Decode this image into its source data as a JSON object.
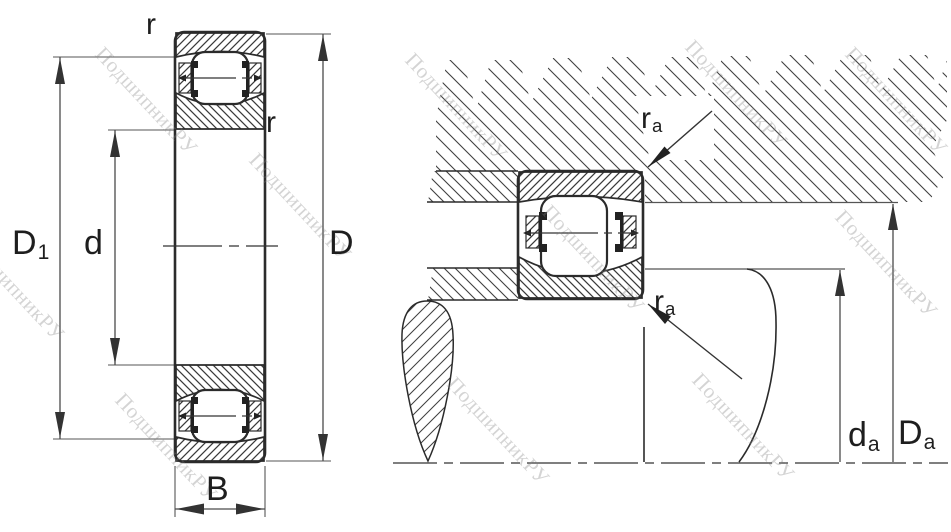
{
  "watermark": {
    "text": "ПодшипникРУ"
  },
  "views": {
    "left": {
      "title": "bearing-cross-section-front-view",
      "labels": {
        "r_top": "r",
        "r_side": "r",
        "outer_raceway_diameter": {
          "main": "D",
          "sub": "1"
        },
        "bore_diameter": "d",
        "outside_diameter": "D",
        "width": "B"
      }
    },
    "right": {
      "title": "mounted-bearing-abutment-section",
      "labels": {
        "fillet_top": {
          "main": "r",
          "sub": "a"
        },
        "fillet_bottom": {
          "main": "r",
          "sub": "a"
        },
        "shaft_abutment_diameter": {
          "main": "d",
          "sub": "a"
        },
        "housing_abutment_diameter": {
          "main": "D",
          "sub": "a"
        }
      }
    }
  },
  "colors": {
    "background": "#ffffff",
    "outline": "#2b2b2b",
    "hatch": "#3a3a3a",
    "dimension_line": "#4a4a4a",
    "label_text": "#1e1e1e",
    "watermark": "#9a9a9a"
  }
}
